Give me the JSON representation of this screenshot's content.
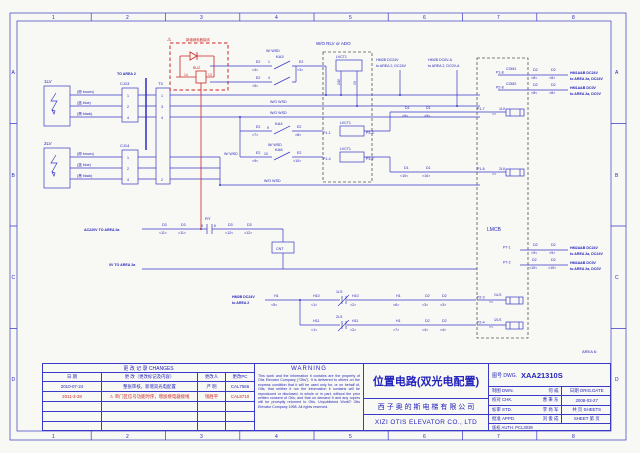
{
  "zones": {
    "cols": [
      "1",
      "2",
      "3",
      "4",
      "5",
      "6",
      "7",
      "8"
    ],
    "rows": [
      "A",
      "B",
      "C",
      "D"
    ]
  },
  "icons": {
    "warning": "⚠"
  },
  "colors": {
    "line": "#3a3ac8",
    "text": "#2424bd",
    "alert": "#cb2525",
    "background": "#f8f8f4"
  },
  "sch": {
    "hdr_rlv": "W/O RLV or ADO",
    "area6": "AREA 6:",
    "sensors": {
      "s1": "1LV",
      "s2": "2LV",
      "brown": "(棕 brown)",
      "blue": "(蓝 blue)",
      "black": "(黑 black)",
      "cj13": "CJ13",
      "cj14": "CJ14",
      "t3": "T3",
      "to_area2": "TO AREA 2",
      "n1": "1",
      "n2": "2",
      "n3": "3",
      "n4": "4"
    },
    "buz": {
      "warn": "新增继电器接线",
      "name": "BUZ",
      "p14": "14",
      "p13": "13"
    },
    "ka": {
      "w_wsd": "W/ WSD",
      "wo_wsd": "W/O WSD",
      "ka3": "KA3",
      "ka4": "KA4",
      "ka6": "KA6",
      "e2": "E2",
      "p4l": "<4<",
      "p3r": ">3>",
      "p5l": "<5<",
      "p7l": "<7<",
      "p8r": ">8>",
      "p9l": "<9<",
      "p10r": ">10>",
      "t1": "1",
      "t4": "4",
      "t9": "9",
      "t10": "10"
    },
    "lvct": {
      "name": "LVCT1",
      "v24": "24V",
      "v0": "0V",
      "p1_1": "P1-1",
      "p3_3": "P3-3",
      "p1_4": "P1-4",
      "p3_2": "P3-2"
    },
    "hm": {
      "l1a": "HM2B DC24V",
      "l1b": "to AREA 2, DC24V",
      "l2a": "HM2B DC0V-A",
      "l2b": "to AREA 2, DC0V-A"
    },
    "d1": {
      "name": "D1",
      "p9l": "<9<",
      "p9r": ">9>",
      "p10l": "<10<",
      "p10r": ">10>"
    },
    "com": {
      "com1": "COM1",
      "com2": "COM2",
      "p1_8": "P1-8",
      "p2_8": "P2-8",
      "d2": "D2",
      "p8l": "<8<",
      "p8r": ">8>",
      "hm24a": "HM1A&B DC24V",
      "hm24b": "to AREA 2a, DC24V",
      "hm0a": "HM1A&B DC0V",
      "hm0b": "to AREA 2a, DC0V"
    },
    "px": {
      "p1_7": "P1-7",
      "p1_6": "P1-6",
      "arr": "<<",
      "s1": "1LV",
      "s2": "2LV"
    },
    "lmcb": {
      "name": "LMCB",
      "p7_1": "P7-1",
      "p7_2": "P7-2",
      "d2": "D2",
      "p9l": "<9<",
      "p9r": ">9>",
      "p10l": "<10<",
      "p10r": ">10>",
      "hm24a": "HM2A&B DC24V",
      "hm24b": "to AREA 2a, DC24V",
      "hm0a": "HM2A&B DC0V",
      "hm0b": "to AREA 2a, DC0V"
    },
    "ls": {
      "srca": "HM2B DC24V",
      "srcb": "to AREA 2",
      "h1": "H1",
      "h10": "H10",
      "h11": "H11",
      "p5l": "<5<",
      "p1l": "<1<",
      "p2r": ">2>",
      "p6r": ">6>",
      "p7r": ">7>",
      "ls1": "1LS",
      "ls2": "2LS",
      "d2": "D2",
      "p3l": "<3<",
      "p3r": ">3>",
      "p4l": "<4<",
      "p4r": ">4>",
      "p2_3": "P2-3",
      "p2_4": "P2-4",
      "sl1": "/1LS",
      "sl2": "/2LS",
      "arr": "<<"
    },
    "pwr": {
      "ac": "AC220V TO AREA 2a",
      "zero": "0V TO AREA 2a",
      "d3": "D3",
      "p11l": "<11<",
      "p11r": ">11>",
      "p12l": "<12<",
      "p12r": ">12>",
      "ry": "RY",
      "n5": "5",
      "n6": "6",
      "cnt": "CNT"
    }
  },
  "tb": {
    "changes": {
      "title": "更 改 记 录   CHANGES",
      "h_date": "日  期",
      "h_desc": "更  改（更改标记及内容）",
      "h_person": "更改人",
      "h_pc": "更改PC",
      "r1": {
        "date": "2010-07-24",
        "desc": "整张审核，新增双光电配置",
        "person": "严  明",
        "pc": "CAL7566"
      },
      "r2": {
        "date": "2011-3-28",
        "desc": "单门区信号功能时序，增加继电器接线",
        "person": "钱胜平",
        "pc": "CAL8710"
      }
    },
    "warning": {
      "title": "WARNING",
      "body": "This work and the information it contains are the property of Otis Elevator Company (\"Otis\"). It is delivered to others on the express condition that it will be used only for, or on behalf of, Otis; that neither it nor the information it contains will be reproduced or disclosed, in whole or in part, without the prior written consent of Otis; and that on demand it and any copies will be promptly returned to Otis.    Unpublished Work© Otis Elevator Company 1998. All rights reserved."
    },
    "title": {
      "cn": "位置电路(双光电配置)",
      "company_cn": "西 子 奥 的 斯 电 梯 有 限 公 司",
      "company_en": "XIZI OTIS ELEVATOR CO., LTD"
    },
    "dwg": {
      "no_label": "图号 DWG.",
      "no": "XAA21310S",
      "dwn_k": "制图 DWN.",
      "dwn_v": "何  威",
      "chk_k": "校对 CHK.",
      "chk_v": "曹 秉 东",
      "std_k": "标审 STD.",
      "std_v": "李 尚 军",
      "appd_k": "批准 APPD.",
      "appd_v": "刘 俊 成",
      "date_k": "日期 ORIG.DATE",
      "date_v": "2008-03-27",
      "sheets_k": "共  页 SHEETS",
      "sheet_k": "SHEET 第  页",
      "auth": "版权 AUTH. PCL3039"
    }
  }
}
